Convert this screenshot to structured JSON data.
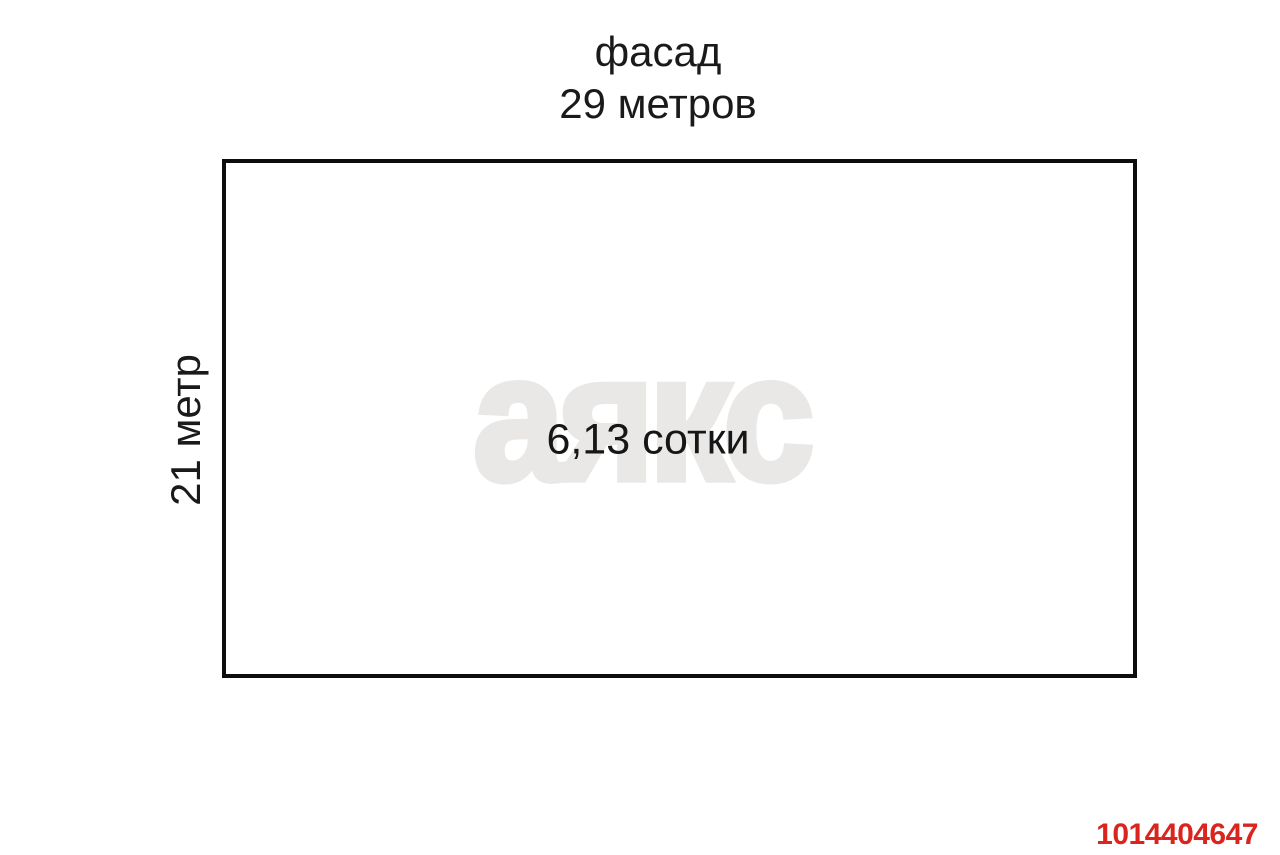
{
  "plot_diagram": {
    "top_label": {
      "line1": "фасад",
      "line2": "29 метров"
    },
    "side_label": "21 метр",
    "area_label": "6,13 сотки",
    "watermark_text": "аякс",
    "listing_id": "1014404647",
    "colors": {
      "background": "#ffffff",
      "outline": "#0d0d0d",
      "text": "#1a1a1a",
      "watermark": "#e9e8e6",
      "listing_id": "#d9251d"
    }
  }
}
